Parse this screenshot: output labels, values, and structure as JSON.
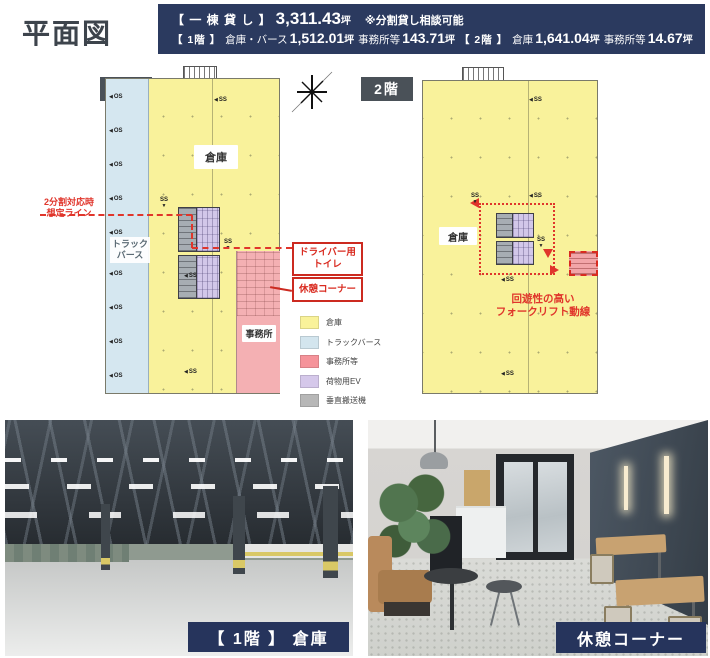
{
  "page": {
    "title": "平面図",
    "accent_red": "#d9332a",
    "badge_bg": "#4a5158"
  },
  "header": {
    "bg": "#2b3a5f",
    "l1_bracket": "【 一 棟 貸 し 】",
    "l1_value": "3,311.43",
    "l1_unit": "坪",
    "l1_note": "※分割貸し相談可能",
    "l2_f1_bracket": "【 1階 】",
    "l2_f1_label": "倉庫・バース",
    "l2_f1_value": "1,512.01",
    "l2_f1_unit": "坪",
    "l2_f1_office": "事務所等",
    "l2_f1_office_value": "143.71",
    "l2_f1_office_unit": "坪",
    "l2_f2_bracket": "【 2階 】",
    "l2_f2_label": "倉庫",
    "l2_f2_value": "1,641.04",
    "l2_f2_unit": "坪",
    "l2_f2_office": "事務所等",
    "l2_f2_office_value": "14.67",
    "l2_f2_office_unit": "坪"
  },
  "floor1": {
    "badge": "1階",
    "warehouse": "倉庫",
    "berth_line1": "トラック",
    "berth_line2": "バース",
    "office": "事務所",
    "os": "OS",
    "ss": "SS",
    "split_note_line1": "2分割対応時",
    "split_note_line2": "想定ライン",
    "callout_toilet_line1": "ドライバー用",
    "callout_toilet_line2": "トイレ",
    "callout_rest": "休憩コーナー"
  },
  "floor2": {
    "badge": "2階",
    "warehouse": "倉庫",
    "ss": "SS",
    "forklift_line1": "回遊性の高い",
    "forklift_line2": "フォークリフト動線"
  },
  "legend": {
    "items": [
      {
        "label": "倉庫",
        "color": "#f9f29a"
      },
      {
        "label": "トラックバース",
        "color": "#d3e5ee"
      },
      {
        "label": "事務所等",
        "color": "#f5939a"
      },
      {
        "label": "荷物用EV",
        "color": "#d5c8ea"
      },
      {
        "label": "垂直搬送機",
        "color": "#b7b7b7"
      }
    ]
  },
  "photos": {
    "caption_bg": "#26345c",
    "warehouse_caption": "【 1階 】 倉庫",
    "rest_caption": "休憩コーナー"
  }
}
